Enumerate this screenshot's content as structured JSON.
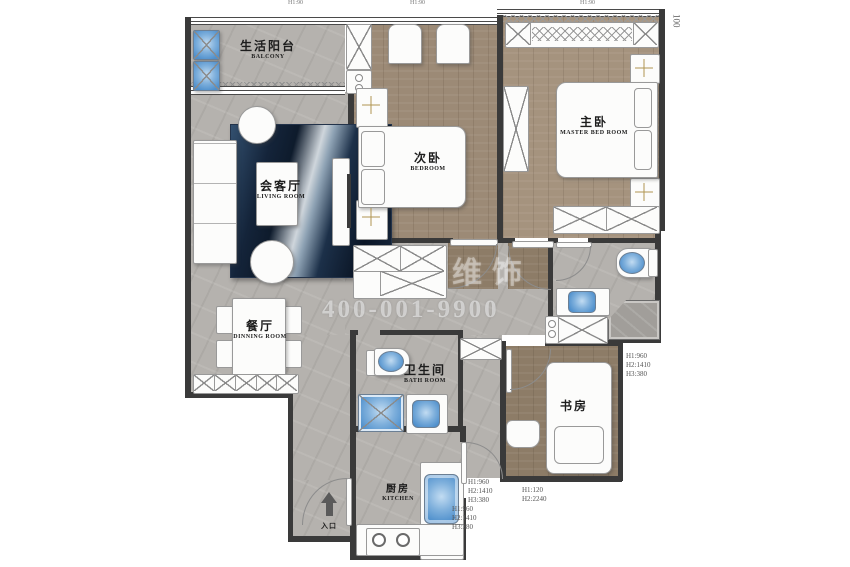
{
  "rooms": {
    "balcony": {
      "zh": "生活阳台",
      "en": "BALCONY"
    },
    "living_room": {
      "zh": "会客厅",
      "en": "LIVING ROOM"
    },
    "dining_room": {
      "zh": "餐厅",
      "en": "DINNING ROOM"
    },
    "bedroom": {
      "zh": "次卧",
      "en": "BEDROOM"
    },
    "master_bedroom": {
      "zh": "主卧",
      "en": "MASTER BED ROOM"
    },
    "bathroom": {
      "zh": "卫生间",
      "en": "BATH ROOM"
    },
    "study": {
      "zh": "书房"
    },
    "kitchen": {
      "zh": "厨房",
      "en": "KITCHEN"
    },
    "entrance": {
      "zh": "入口"
    }
  },
  "dimensions": {
    "top_left": "H1:90",
    "top_center": "H1:90",
    "top_right": "H1:90",
    "right_side": "100",
    "study_block": [
      "H1:960",
      "H2:1410",
      "H3:380"
    ],
    "kitchen_block_a": [
      "H1:960",
      "H2:1410",
      "H3:380"
    ],
    "kitchen_block_b": [
      "H1:960",
      "H2:1410",
      "H3:380"
    ],
    "entry_block": [
      "H1:120",
      "H2:2240"
    ]
  },
  "watermark": {
    "logo": "维饰",
    "phone": "400-001-9900"
  },
  "colors": {
    "tile": "#b5b2ae",
    "wood": "#9c8a76",
    "wood_dark": "#8d7c67",
    "wall": "#3a3a3a",
    "fixture_blue": "#4e8fcc",
    "lamp_yellow": "#e3c98b",
    "rug_navy": "#16263c"
  }
}
